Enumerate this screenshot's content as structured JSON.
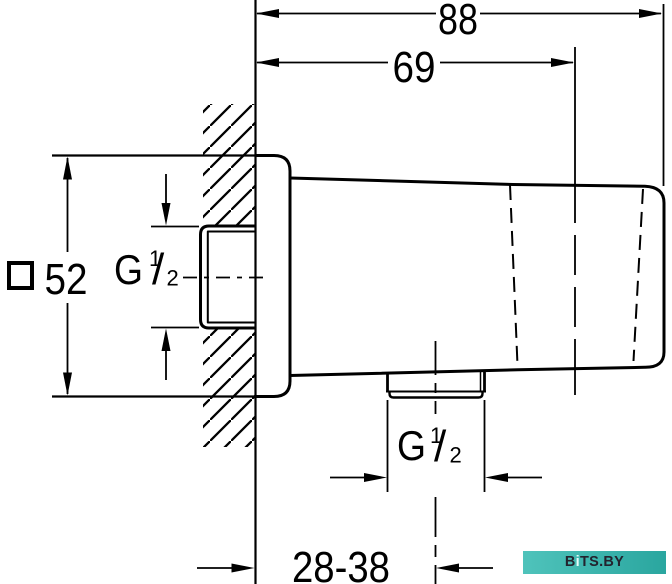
{
  "dimensions": {
    "total_depth": "88",
    "body_depth": "69",
    "flange_height": "52",
    "mount_range": "28-38"
  },
  "symbols": {
    "square": "□"
  },
  "thread_label_left": {
    "g": "G",
    "numerator": "1",
    "slash": "/",
    "denominator": "2"
  },
  "thread_label_bottom": {
    "g": "G",
    "numerator": "1",
    "slash": "/",
    "denominator": "2"
  },
  "watermark": {
    "b": "B",
    "i": "i",
    "rest": "TS.BY"
  },
  "colors": {
    "line": "#000000",
    "bg": "#ffffff",
    "wm_left": "#4fc3bb",
    "wm_right": "#2aa69f",
    "wm_text": "#23232e",
    "wm_i": "#eafcfa"
  }
}
